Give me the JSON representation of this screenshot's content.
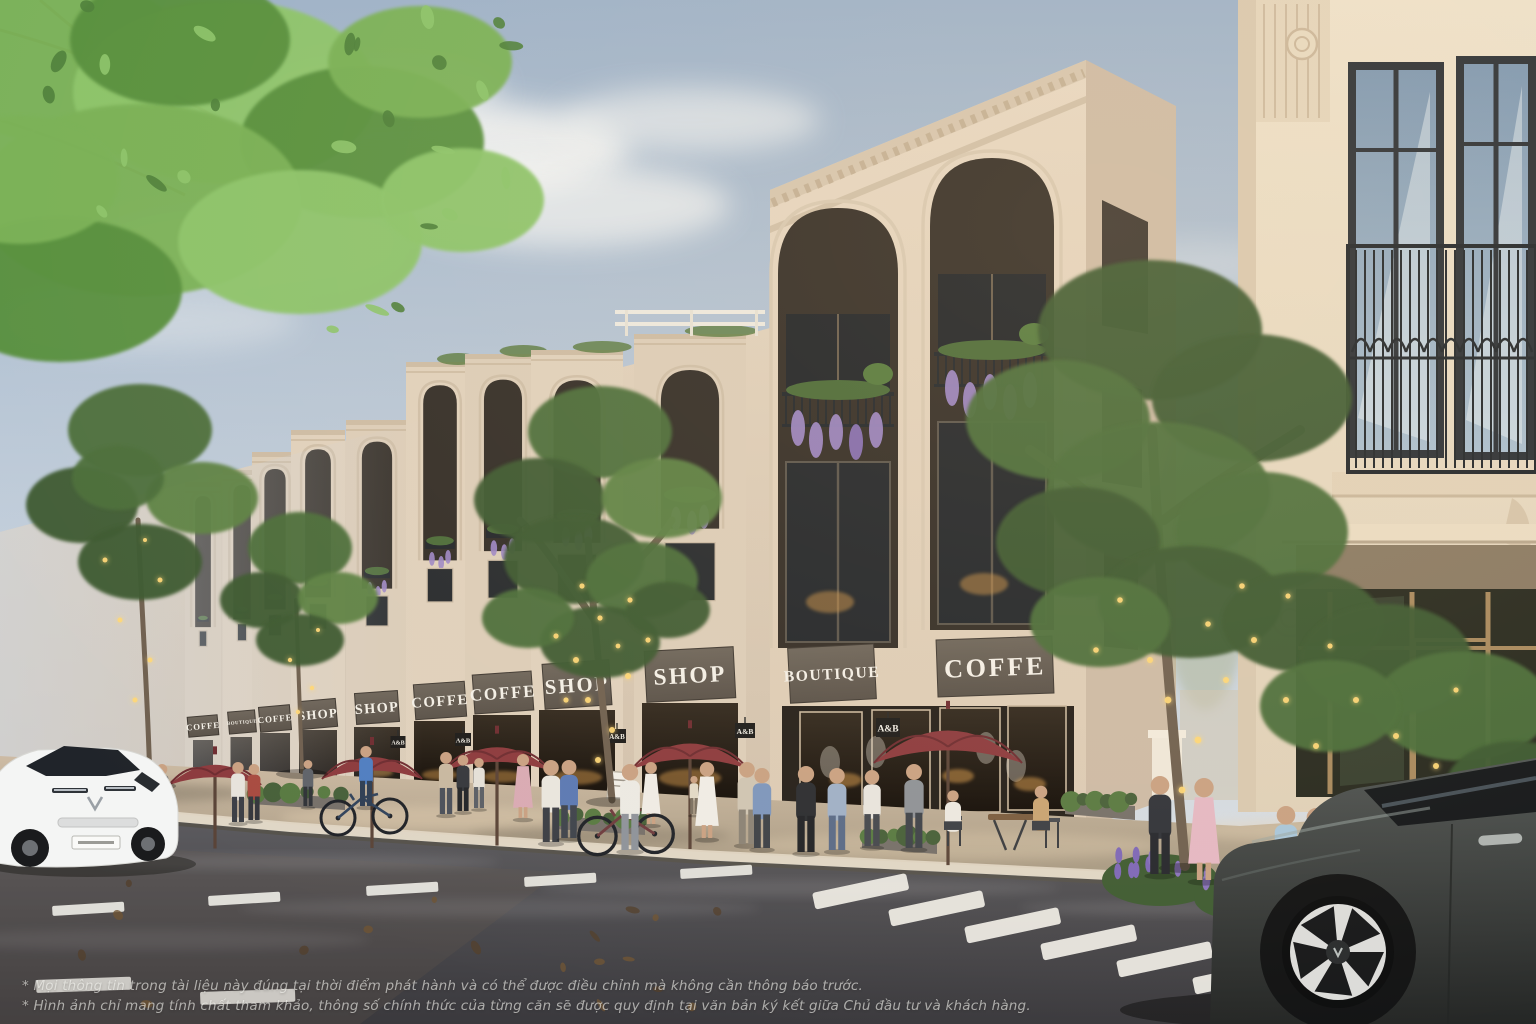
{
  "scene": {
    "description": "Sunlit architectural render of a neoclassical shophouse street: a receding row of cream three-storey shophouses with arched balconies and wisteria, shop signboards, street trees wrapped in golden string lights, pedestrians and cyclists on the sidewalk, maroon cafe umbrellas, a white SUV on the left road and a dark grey SUV in the right foreground crossing a dashed crosswalk."
  },
  "signs": {
    "hanging_label": "A&B",
    "boards": [
      {
        "label": "COFFE"
      },
      {
        "label": "BOUTIQUE"
      },
      {
        "label": "COFFE"
      },
      {
        "label": "SHOP"
      },
      {
        "label": "SHOP"
      },
      {
        "label": "COFFE"
      },
      {
        "label": "COFFE"
      },
      {
        "label": "SHOP"
      },
      {
        "label": "SHOP"
      },
      {
        "label": "BOUTIQUE"
      },
      {
        "label": "COFFE"
      }
    ]
  },
  "disclaimer": {
    "line1": "* Mọi thông tin trong tài liệu này đúng tại thời điểm phát hành và có thể được điều chỉnh mà không cần thông báo trước.",
    "line2": "* Hình ảnh chỉ mang tính chất tham khảo, thông số chính thức của từng căn sẽ được quy định tại văn bản ký kết giữa Chủ đầu tư và khách hàng."
  },
  "colors": {
    "sky1": "#9db2ca",
    "sky2": "#c3cfdc",
    "sky3": "#e4e6e8",
    "cloud": "#f4f6f6",
    "facade": "#e7d8c4",
    "facadeShade": "#cdbba6",
    "facadeDark": "#d6c6b0",
    "row1": "#e0d1bd",
    "row2": "#d2c2ae",
    "right1": "#eee2cc",
    "right2": "#e0d1b9",
    "signboard": "#5a524a",
    "signboard2": "#6e665c",
    "signText": "#f4f0e8",
    "iron": "#21262b",
    "glassDark": "#22262b",
    "glassBlue1": "#7e98b2",
    "glassBlue2": "#aabfd0",
    "warm": "#cf9448",
    "road1": "#5d5c60",
    "road2": "#3a393d",
    "walk1": "#cdbba4",
    "walk2": "#a2957f",
    "curb": "#e0d6c4",
    "umbrella": "#8c3a3e",
    "gold": "#ffd878",
    "leaf1": "#3d5a30",
    "leaf2": "#4c6e3a",
    "leaf3": "#5d8245",
    "leafBright": "#79b156",
    "leafBright2": "#8cc46a",
    "trunk": "#6f6050",
    "wisteria": "#9d87c6",
    "wisteria2": "#8a72b8",
    "skin": "#c9a183",
    "carWhite": "#f4f5f4",
    "carDark1": "#505554",
    "carDark2": "#242625",
    "marking": "#eceae4"
  }
}
